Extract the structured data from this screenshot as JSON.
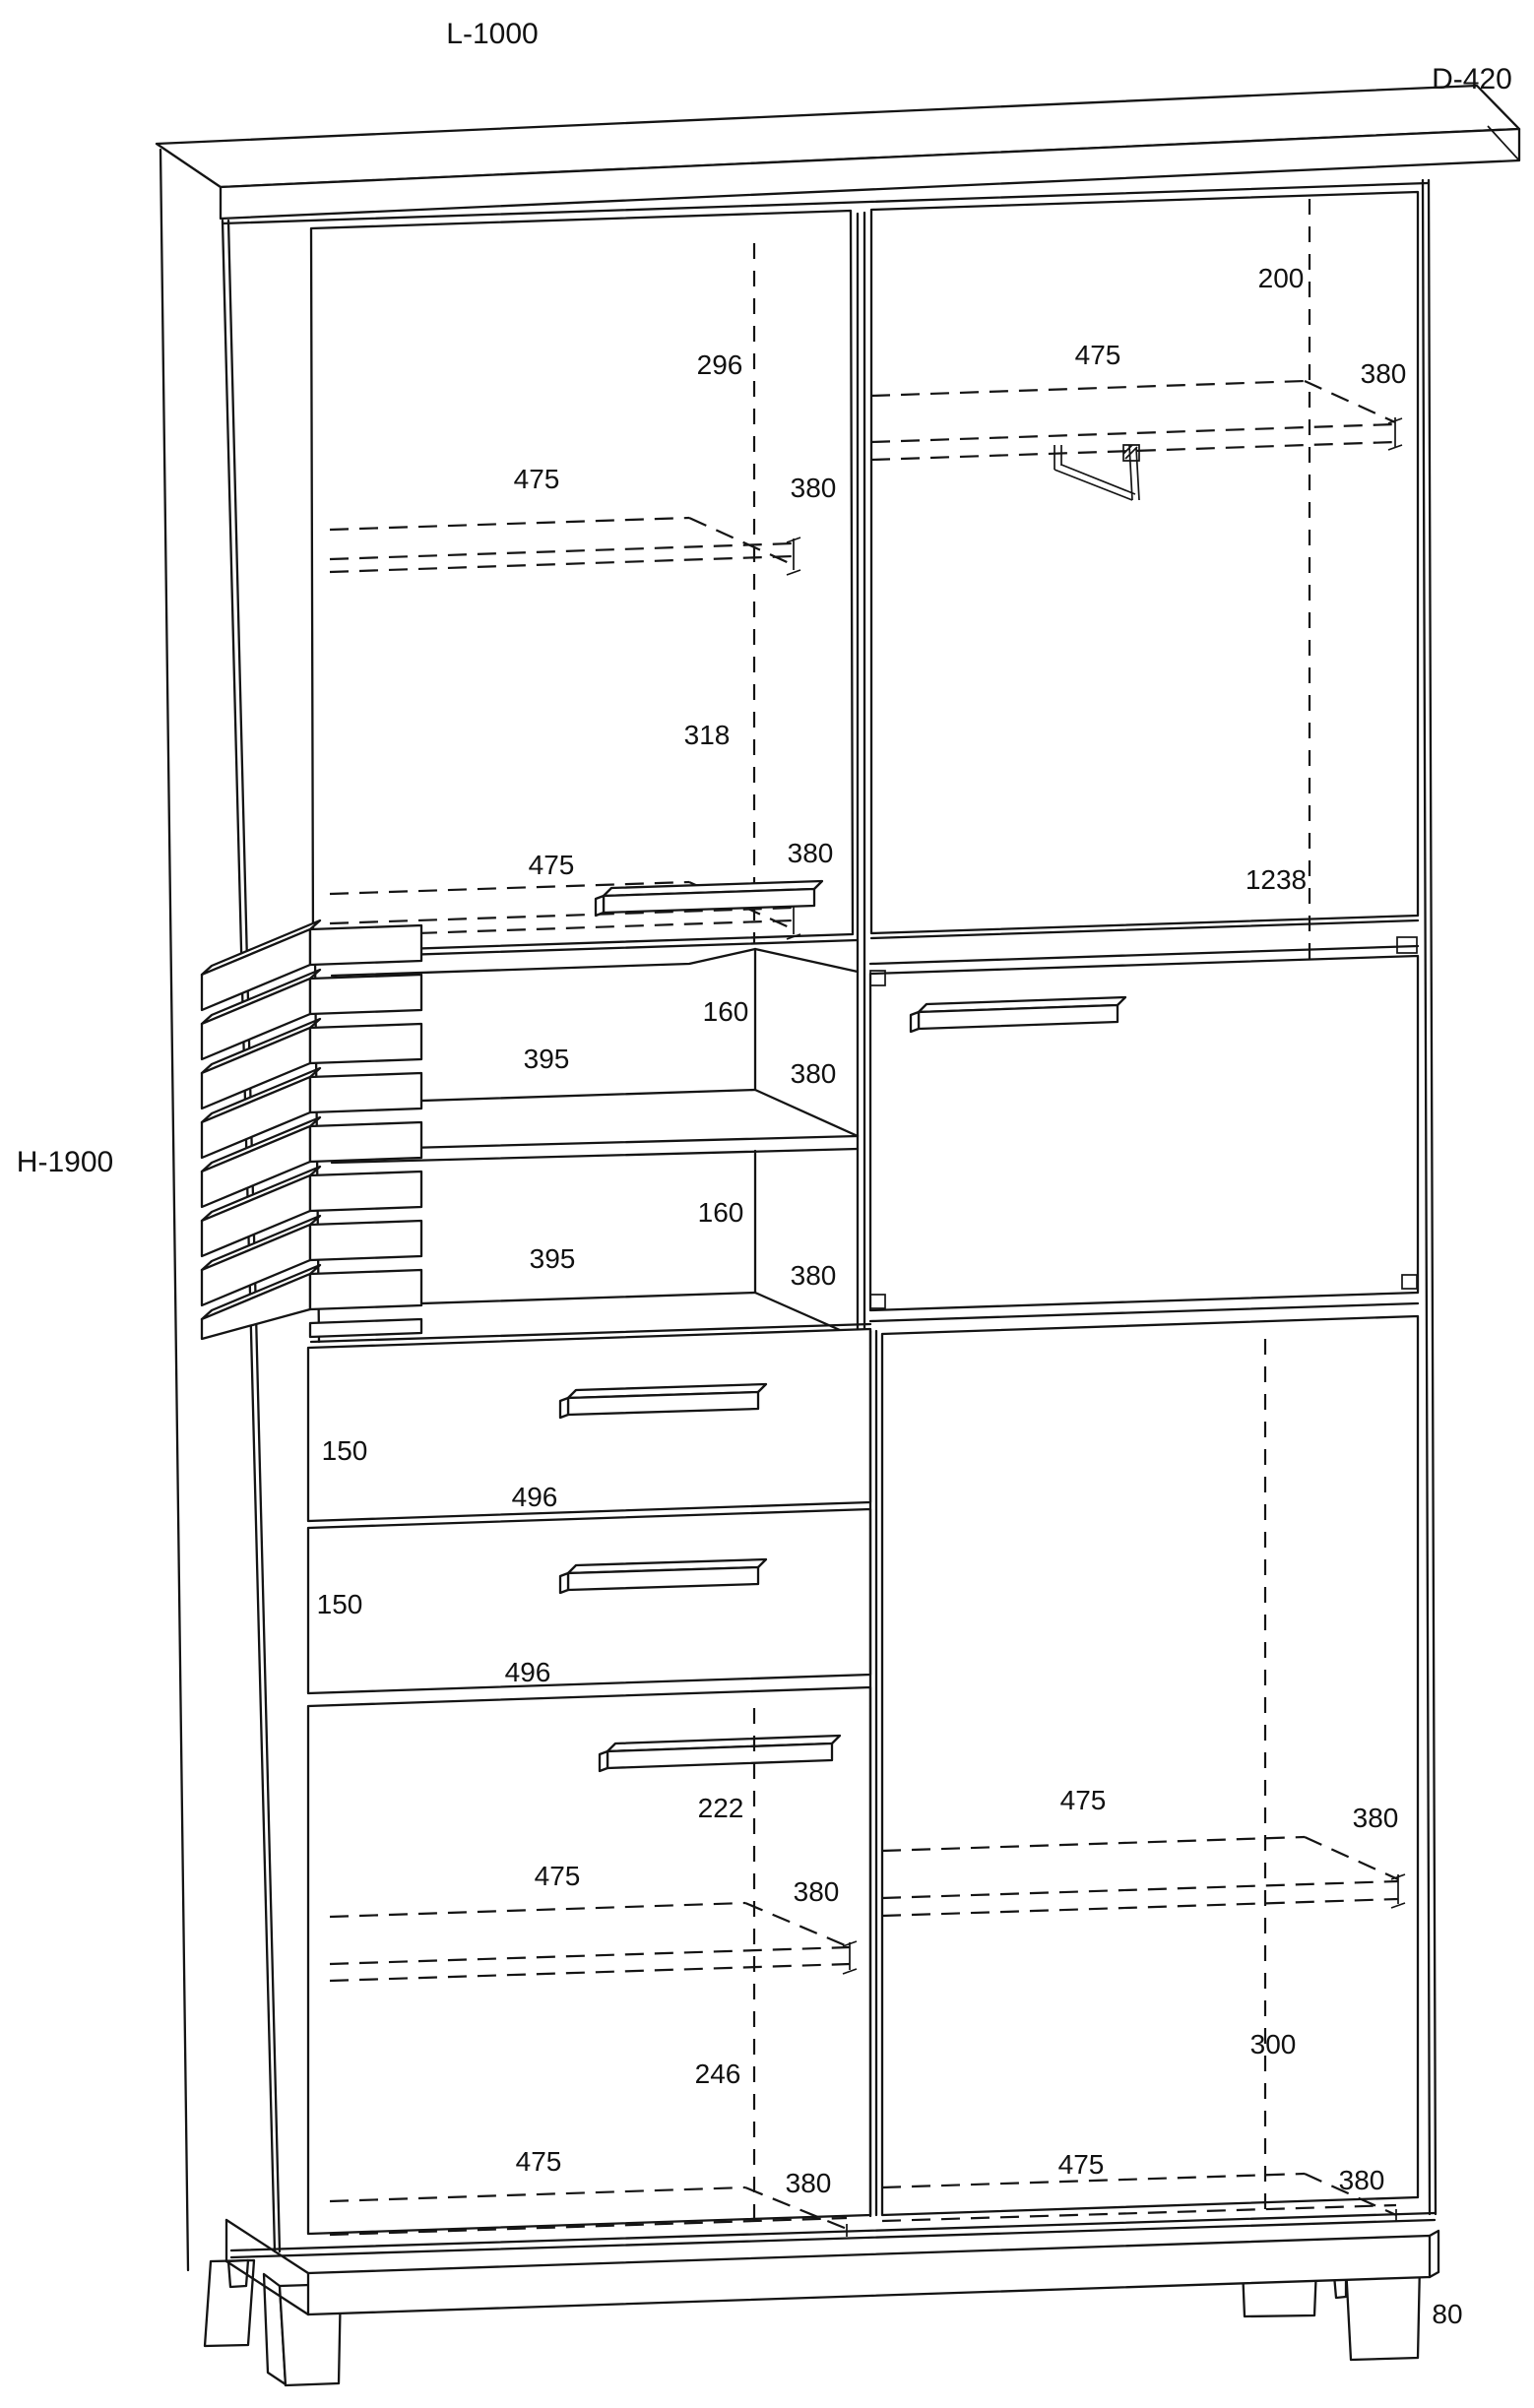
{
  "drawing": {
    "overall": {
      "length": "L-1000",
      "depth": "D-420",
      "height": "H-1900",
      "foot_height": "80"
    },
    "upper_left_door": {
      "top_to_shelf": "296",
      "shelf_a_width": "475",
      "shelf_a_depth": "380",
      "shelf_spacing": "318",
      "shelf_b_width": "475",
      "shelf_b_depth": "380"
    },
    "upper_right_door": {
      "top_to_rail": "200",
      "rail_shelf_width": "475",
      "rail_shelf_depth": "380",
      "door_height": "1238"
    },
    "niche": {
      "upper_height": "160",
      "upper_width": "395",
      "upper_depth": "380",
      "lower_height": "160",
      "lower_width": "395",
      "lower_depth": "380"
    },
    "drawers": {
      "first_height": "150",
      "first_width": "496",
      "second_height": "150",
      "second_width": "496"
    },
    "lower_left_door": {
      "top_to_shelf": "222",
      "shelf_width": "475",
      "shelf_depth": "380",
      "shelf_to_bottom": "246",
      "bottom_width": "475",
      "bottom_depth": "380"
    },
    "lower_right_door": {
      "shelf_width": "475",
      "shelf_depth": "380",
      "shelf_to_bottom": "300",
      "bottom_width": "475",
      "bottom_depth": "380"
    }
  }
}
